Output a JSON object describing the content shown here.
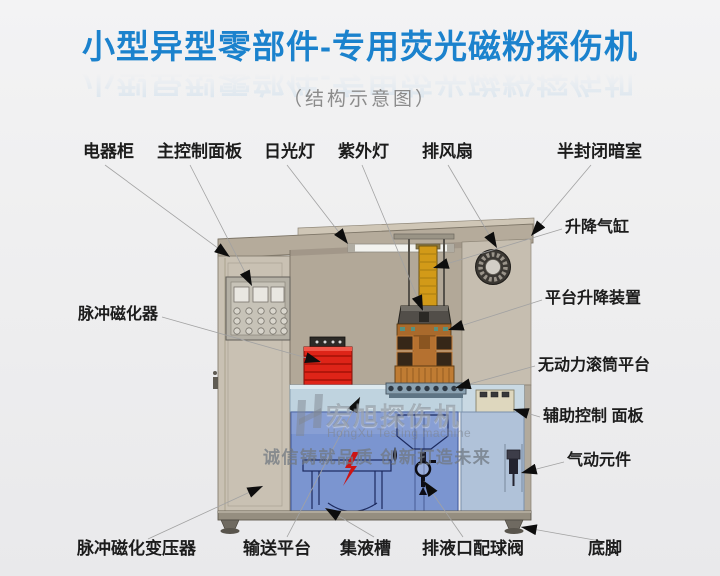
{
  "title": {
    "text": "小型异型零部件-专用荧光磁粉探伤机",
    "subtitle": "（结构示意图）"
  },
  "watermark": {
    "brand": "宏旭探伤机",
    "brand_en": "HongXu Testing machine",
    "slogan": "诚信铸就品质  创新打造未来",
    "logo_icon": "hongxu-h-logo"
  },
  "callouts": {
    "top": [
      "电器柜",
      "主控制面板",
      "日光灯",
      "紫外灯",
      "排风扇",
      "半封闭暗室"
    ],
    "right": [
      "升降气缸",
      "平台升降装置",
      "无动力滚筒平台",
      "辅助控制 面板",
      "气动元件"
    ],
    "left": [
      "脉冲磁化器"
    ],
    "bottom": [
      "脉冲磁化变压器",
      "输送平台",
      "集液槽",
      "排液口配球阀",
      "底脚"
    ]
  },
  "colors": {
    "title_blue": "#1b82cd",
    "cabinet_beige": "#c9c1b3",
    "roof_tan": "#b5ab9b",
    "darkroom_wall": "#b2a898",
    "magnetizer_red": "#de2418",
    "coil_orange": "#b57130",
    "cylinder_yellow": "#d29a18",
    "door_blue": "#7590cf",
    "table_blue": "#bfd3df",
    "label_black": "#1c1c1c"
  }
}
